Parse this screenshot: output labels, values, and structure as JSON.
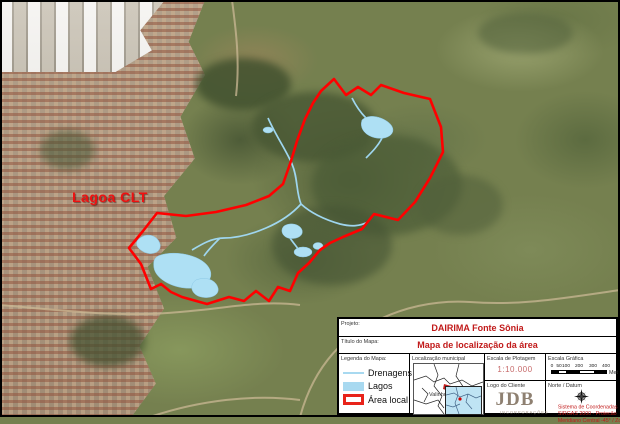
{
  "map": {
    "area_label": "Lagoa CLT",
    "colors": {
      "boundary": "#ff0000",
      "water": "#aee0f4",
      "label_red": "#ee1111"
    }
  },
  "title_block": {
    "project": {
      "label": "Projeto:",
      "value": "DAIRIMA Fonte Sônia"
    },
    "map_title": {
      "label": "Título do Mapa:",
      "value": "Mapa de localização da área"
    },
    "legend": {
      "header": "Legenda do Mapa:",
      "items": [
        {
          "label": "Drenagens",
          "swatch": "line"
        },
        {
          "label": "Lagos",
          "swatch": "fill"
        },
        {
          "label": "Área local",
          "swatch": "outline"
        }
      ]
    },
    "inset": {
      "header": "Localização municipal",
      "city_label": "Valinhos"
    },
    "plot_scale": {
      "header": "Escala de Plotagem",
      "value": "1:10.000"
    },
    "graphic_scale": {
      "header": "Escala Gráfica",
      "ticks": [
        "0",
        "50",
        "100",
        "200",
        "300",
        "400"
      ],
      "unit": "Metros"
    },
    "client_logo": {
      "header": "Logo do Cliente",
      "name": "JDB",
      "subtitle": "INCORPORAÇÕES"
    },
    "north_datum": {
      "header": "Norte / Datum",
      "lines": [
        "Sistema de Coordenadas",
        "SIRGAS 2000 - Projeção UTM",
        "Meridiano Central -45° / Zona 23"
      ]
    }
  }
}
